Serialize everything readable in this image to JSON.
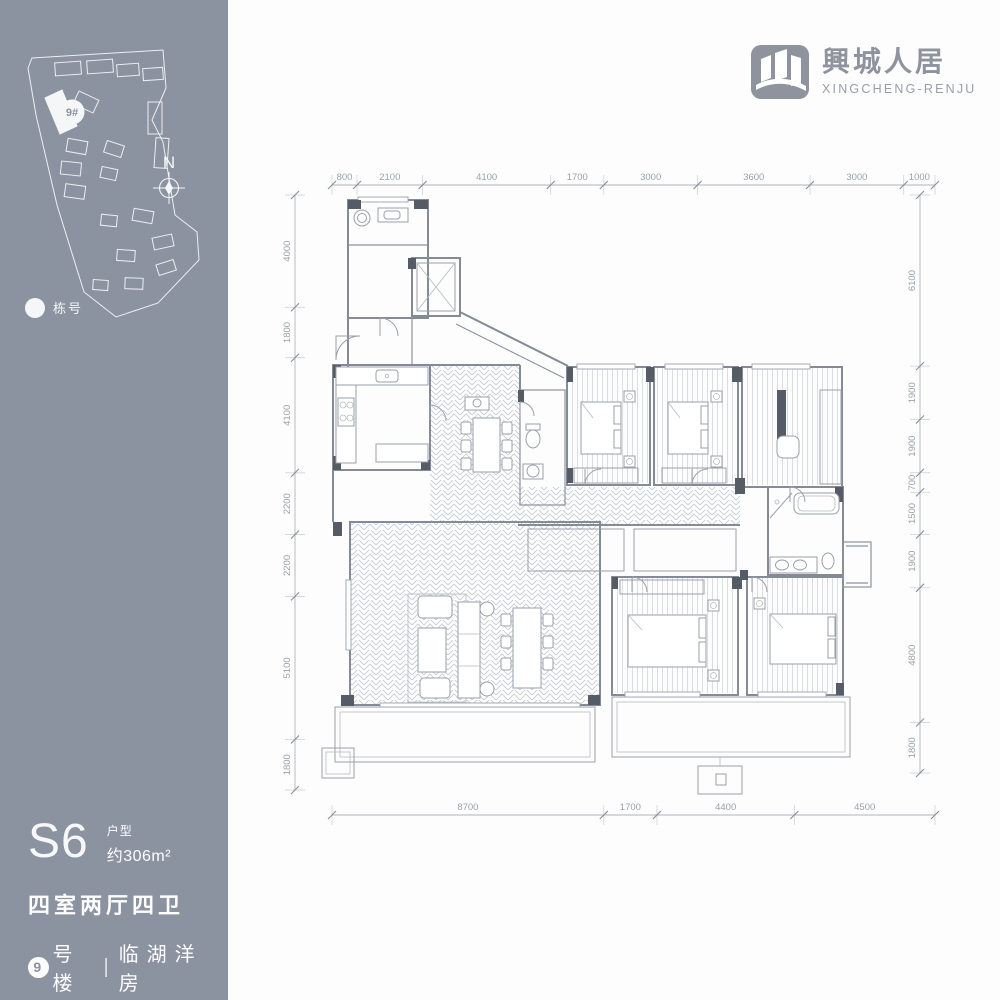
{
  "brand": {
    "logo_title": "興城人居",
    "logo_subtitle": "XINGCHENG-RENJU"
  },
  "sidebar": {
    "panel_color": "#8b93a1",
    "site_plan": {
      "highlight_label": "9#",
      "north_label": "N",
      "legend_label": "栋号"
    },
    "unit": {
      "code": "S6",
      "type_label": "户型",
      "area_label": "约306m²",
      "layout_label": "四室两厅四卫",
      "building_badge": "9",
      "building_label": "号楼",
      "divider": "|",
      "location_label": "临湖洋房"
    }
  },
  "floor_plan": {
    "dimensions": {
      "top": [
        800,
        2100,
        4100,
        1700,
        3000,
        3600,
        3000,
        1000
      ],
      "bottom": [
        8700,
        1700,
        4400,
        4500
      ],
      "left": [
        4000,
        1800,
        4100,
        2200,
        2200,
        5100,
        1800
      ],
      "right": [
        6100,
        1900,
        1900,
        700,
        1500,
        1900,
        4800,
        1800
      ]
    }
  }
}
